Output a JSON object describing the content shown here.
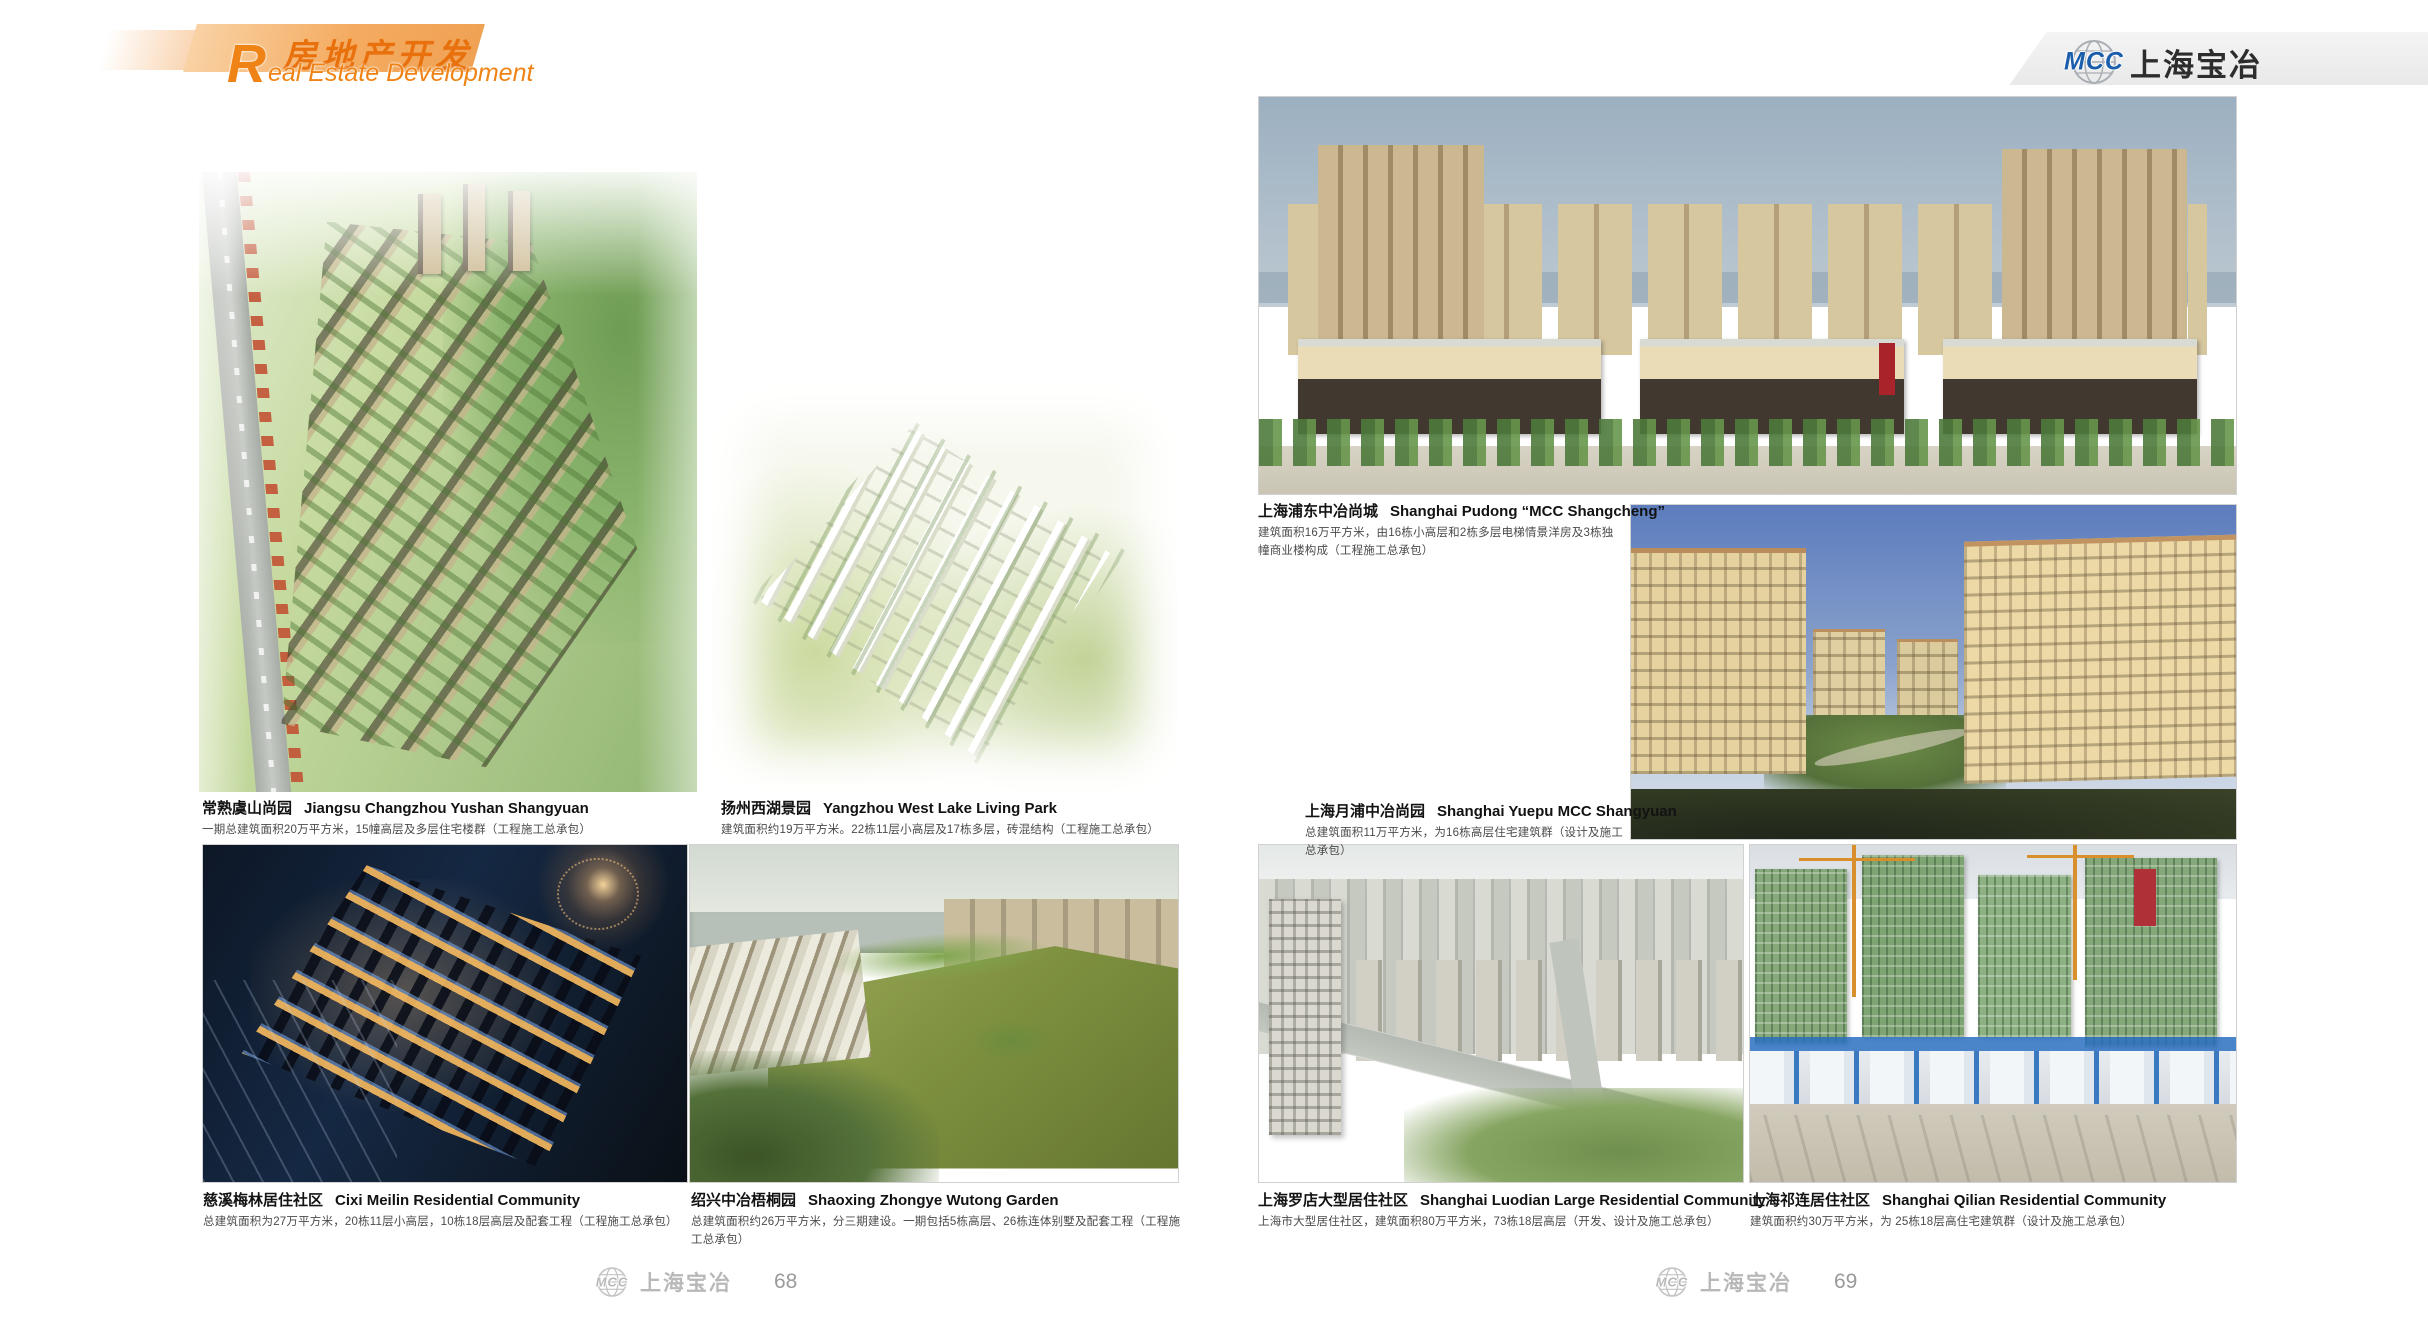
{
  "header": {
    "title_cn": "房地产开发",
    "title_en_initial": "R",
    "title_en_rest": "eal Estate Development"
  },
  "brand": {
    "mcc": "MCC",
    "company": "上海宝冶"
  },
  "footer": {
    "left": {
      "company": "上海宝冶",
      "page_number": "68"
    },
    "right": {
      "company": "上海宝冶",
      "page_number": "69"
    }
  },
  "colors": {
    "accent_orange": "#ED7511",
    "band_orange": "#F4AB60",
    "logo_blue": "#1A5DAB",
    "caption_title": "#121212",
    "caption_desc": "#4A4A4A",
    "footer_gray": "#B8B8B8"
  },
  "projects": [
    {
      "title_cn": "常熟虞山尚园",
      "title_en": "Jiangsu Changzhou Yushan Shangyuan",
      "desc": "一期总建筑面积20万平方米，15幢高层及多层住宅楼群（工程施工总承包）"
    },
    {
      "title_cn": "扬州西湖景园",
      "title_en": "Yangzhou West Lake Living Park",
      "desc": "建筑面积约19万平方米。22栋11层小高层及17栋多层，砖混结构（工程施工总承包）"
    },
    {
      "title_cn": "上海浦东中冶尚城",
      "title_en": "Shanghai Pudong “MCC Shangcheng”",
      "desc": "建筑面积16万平方米，由16栋小高层和2栋多层电梯情景洋房及3栋独幢商业楼构成（工程施工总承包）"
    },
    {
      "title_cn": "上海月浦中冶尚园",
      "title_en": "Shanghai Yuepu MCC Shangyuan",
      "desc": "总建筑面积11万平方米，为16栋高层住宅建筑群（设计及施工总承包）"
    },
    {
      "title_cn": "慈溪梅林居住社区",
      "title_en": "Cixi Meilin Residential Community",
      "desc": "总建筑面积为27万平方米，20栋11层小高层，10栋18层高层及配套工程（工程施工总承包）"
    },
    {
      "title_cn": "绍兴中冶梧桐园",
      "title_en": "Shaoxing Zhongye Wutong Garden",
      "desc": "总建筑面积约26万平方米，分三期建设。一期包括5栋高层、26栋连体别墅及配套工程（工程施工总承包）"
    },
    {
      "title_cn": "上海罗店大型居住社区",
      "title_en": "Shanghai Luodian Large Residential Community",
      "desc": "上海市大型居住社区，建筑面积80万平方米，73栋18层高层（开发、设计及施工总承包）"
    },
    {
      "title_cn": "上海祁连居住社区",
      "title_en": "Shanghai Qilian Residential Community",
      "desc": "建筑面积约30万平方米，为 25栋18层高住宅建筑群（设计及施工总承包）"
    }
  ]
}
